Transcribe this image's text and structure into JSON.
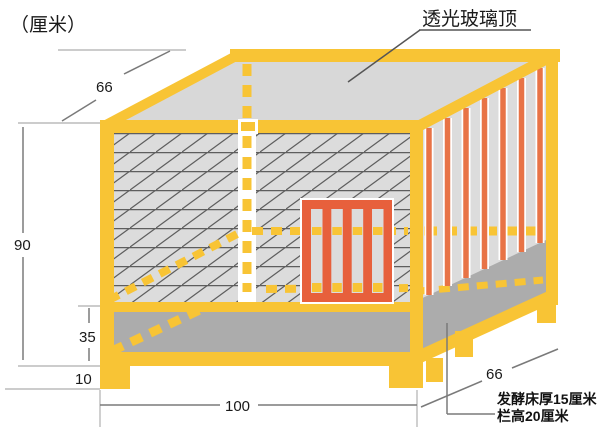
{
  "unit_label": "（厘米）",
  "callouts": {
    "glass_top": "透光玻璃顶",
    "bed_note_line1": "发酵床厚15厘米",
    "bed_note_line2": "栏高20厘米"
  },
  "dimensions": {
    "top_depth_cm": "66",
    "total_height_cm": "90",
    "bed_wall_height_cm": "35",
    "leg_height_cm": "10",
    "front_width_cm": "100",
    "right_depth_cm": "66"
  },
  "colors": {
    "frame_yellow": "#F8C435",
    "door_orange": "#E7603C",
    "bar_orange": "#E87346",
    "glass_gray": "#D8D8D8",
    "panel_gray": "#DCDCDC",
    "bed_gray": "#ACACAC",
    "hatch_line": "#5E5E5E",
    "dim_line": "#7A7A7A",
    "ext_line": "#BBBBBB",
    "text": "#1A1A1A"
  }
}
